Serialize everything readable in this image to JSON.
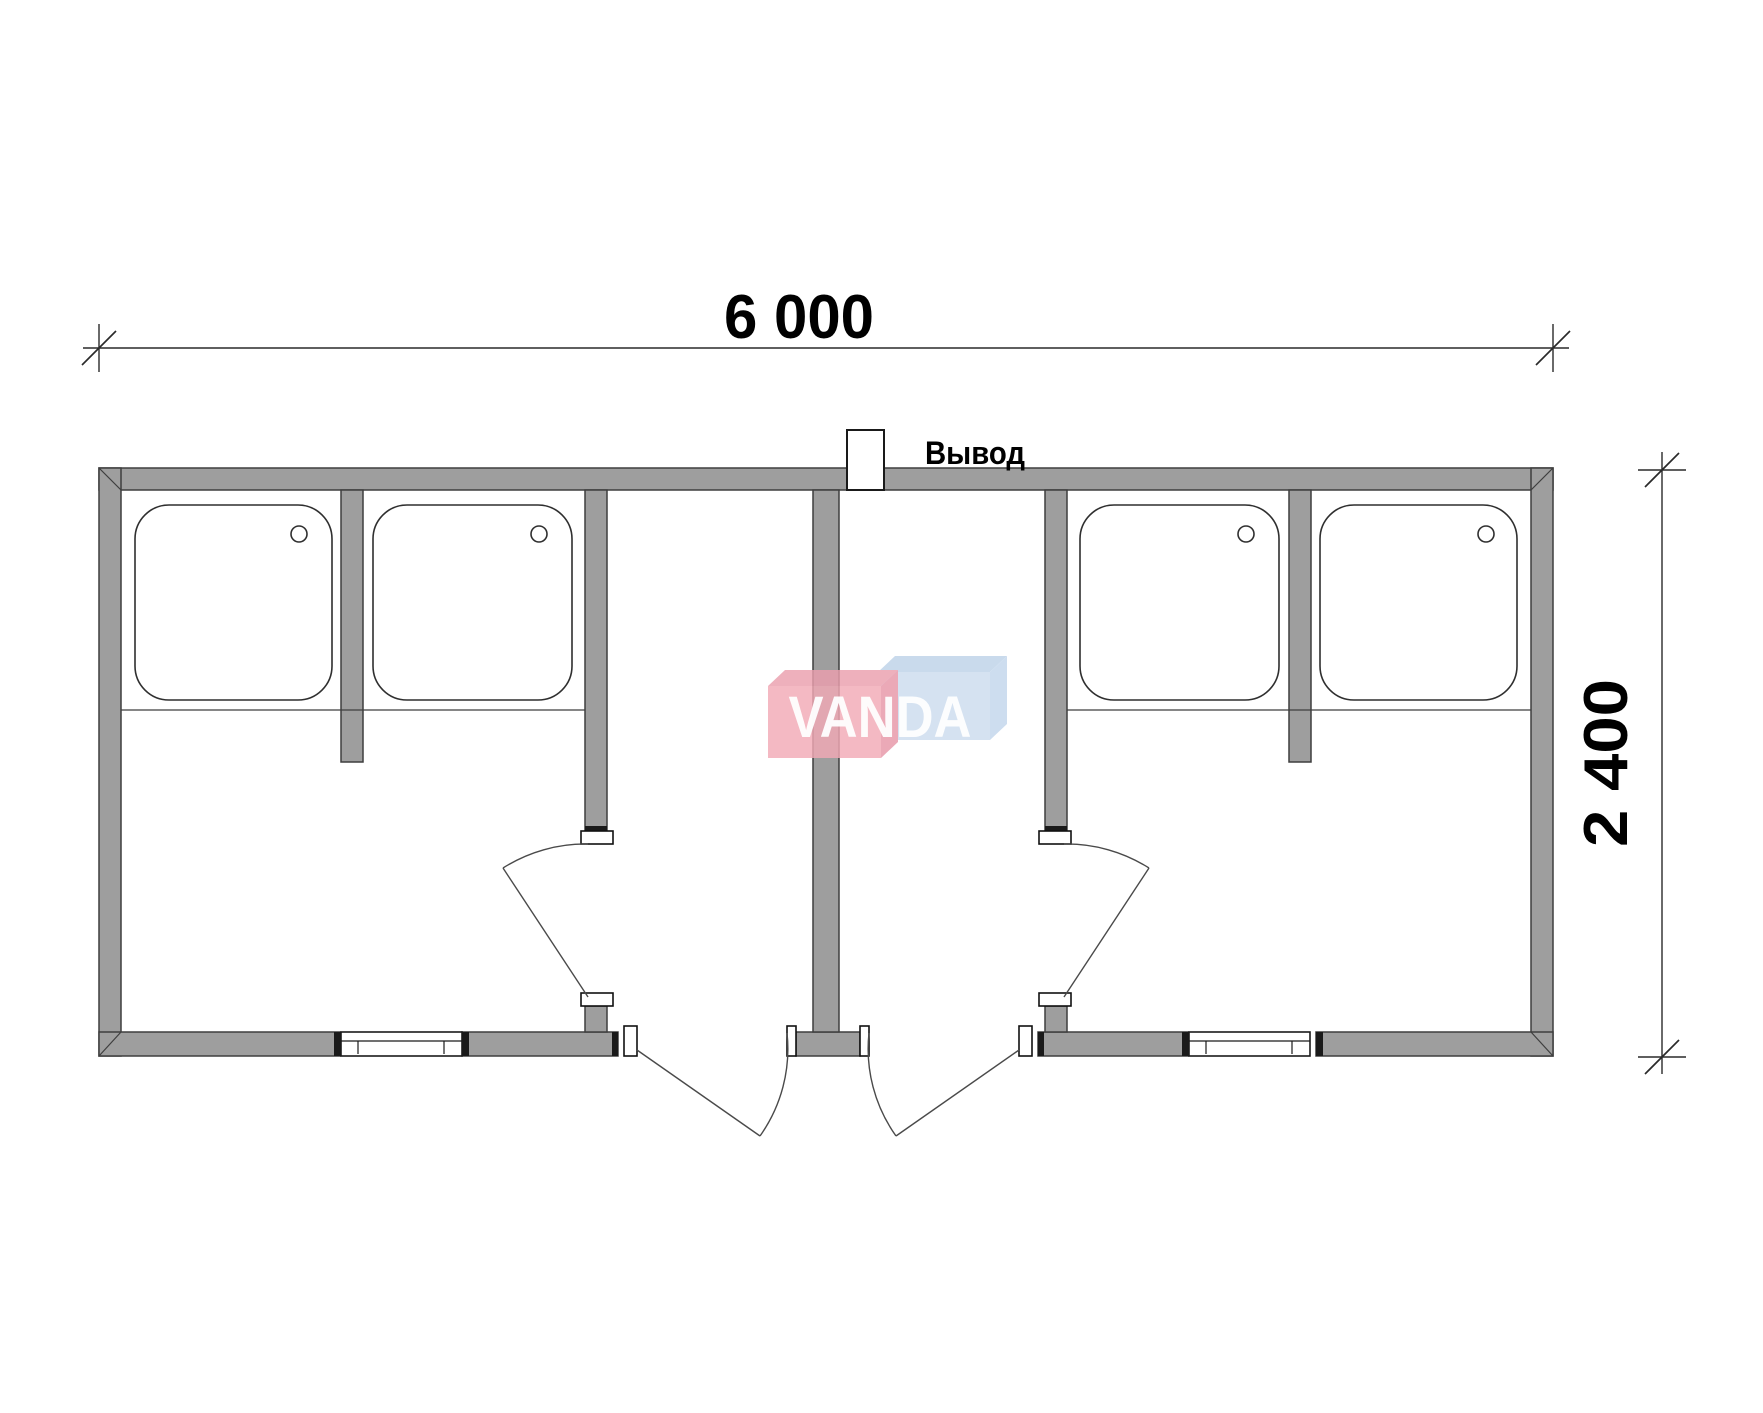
{
  "drawing": {
    "type": "floor-plan",
    "units": "mm"
  },
  "dimensions": {
    "width_label": "6 000",
    "height_label": "2 400"
  },
  "annotations": {
    "outlet_label": "Вывод"
  },
  "watermark": {
    "text": "VANDA",
    "red_front": "#f2aab6",
    "red_top": "#eb9fae",
    "red_side": "#e797a8",
    "blue_front": "#ccdcee",
    "blue_top": "#bed3e9",
    "blue_side": "#c3d6ec"
  },
  "colors": {
    "wall_fill": "#9e9e9e",
    "wall_outline": "#3e3e3e",
    "fixture_outline": "#2f2f2f",
    "door_line": "#4a4a4a",
    "dimension_line": "#2a2a2a",
    "cap_outline": "#111111"
  },
  "fixtures": {
    "shower_tray_count": 4,
    "entrance_door_count": 2,
    "interior_door_count": 2,
    "window_count": 2
  }
}
